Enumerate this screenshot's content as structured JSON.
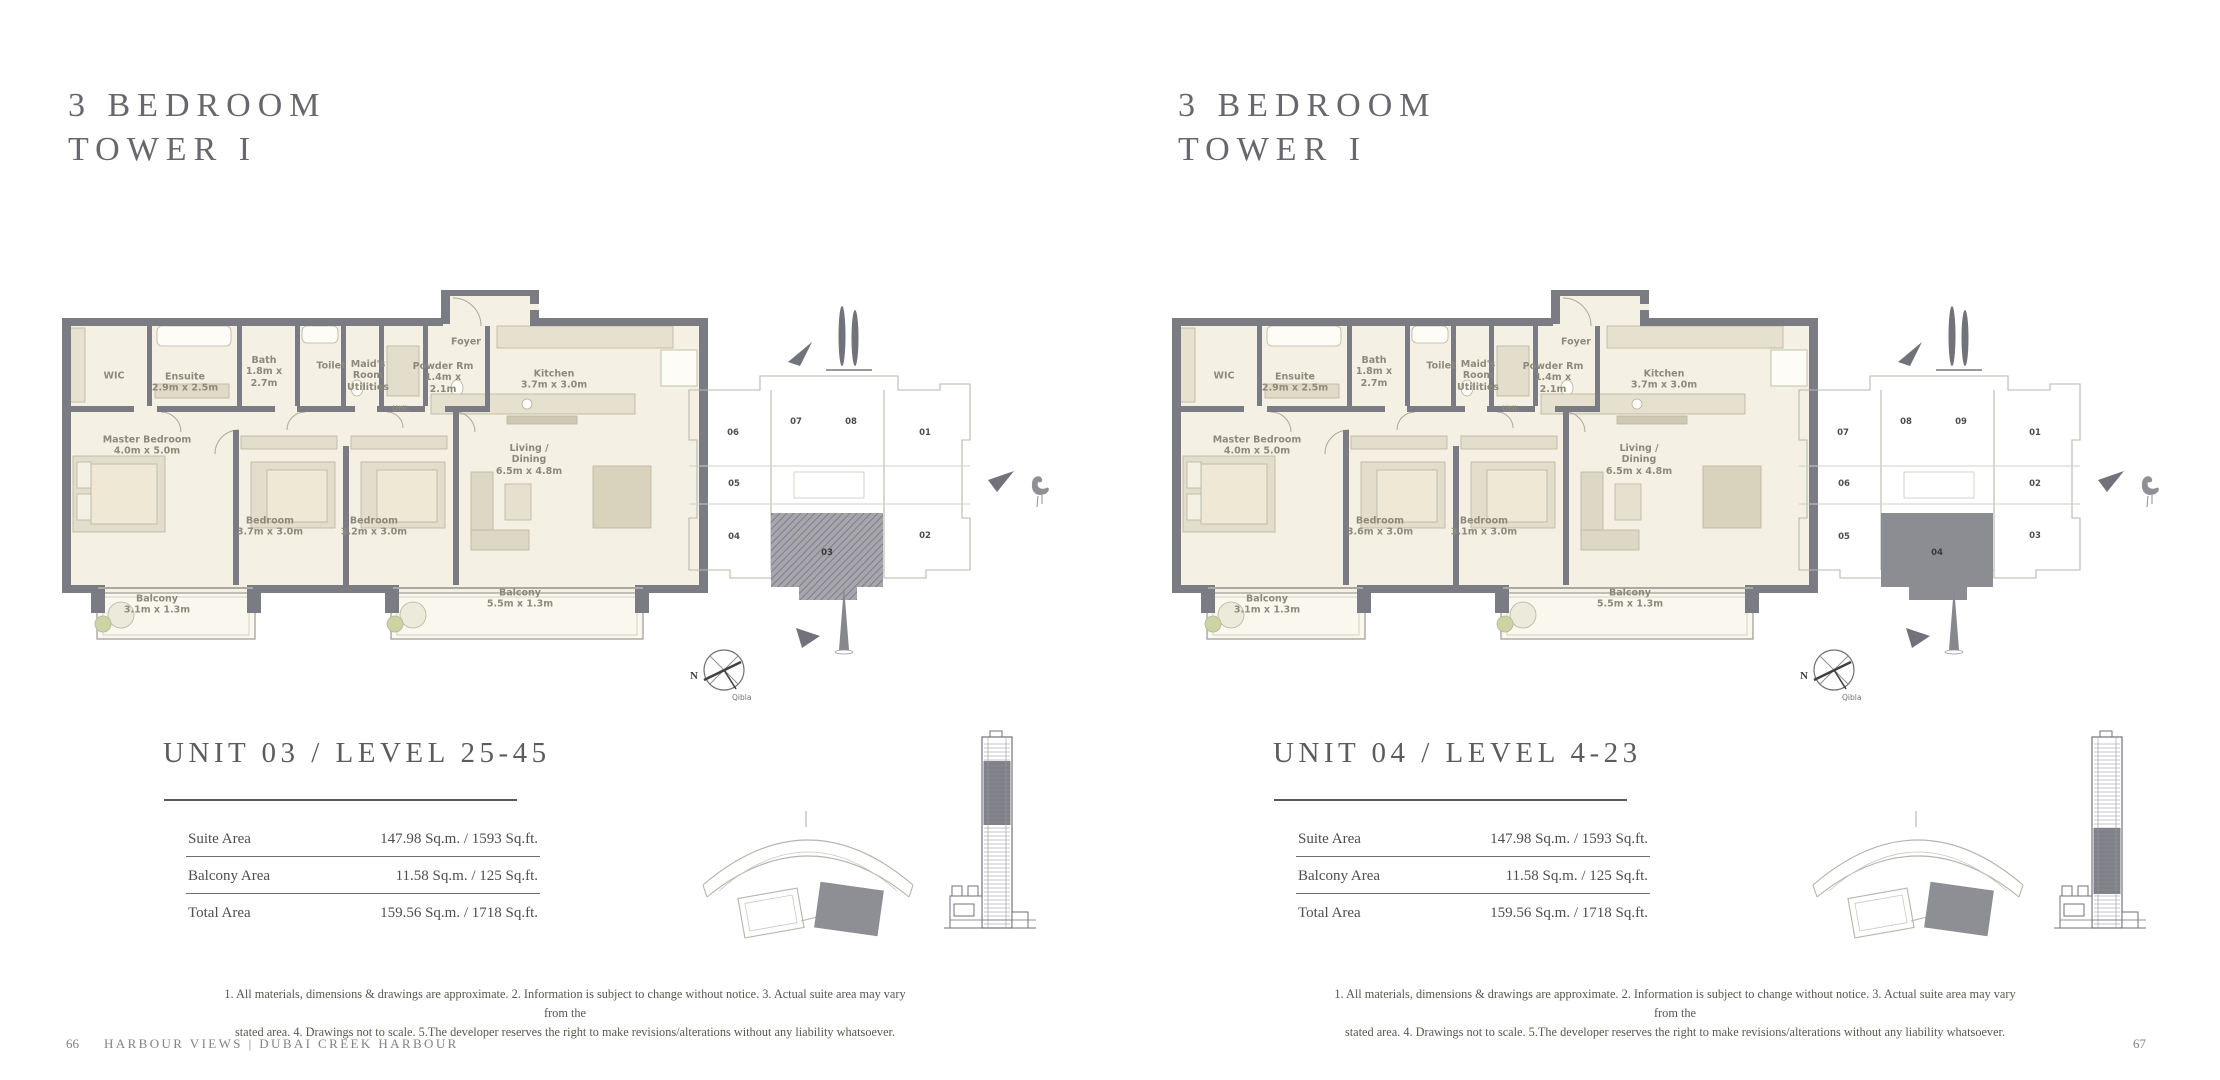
{
  "pages": [
    {
      "title_line1": "3 BEDROOM",
      "title_line2": "TOWER I",
      "plan": {
        "rooms": [
          {
            "lines": [
              "WIC"
            ],
            "x": 57,
            "y": 88
          },
          {
            "lines": [
              "Ensuite",
              "2.9m x 2.5m"
            ],
            "x": 128,
            "y": 95
          },
          {
            "lines": [
              "Bath",
              "1.8m x",
              "2.7m"
            ],
            "x": 207,
            "y": 84
          },
          {
            "lines": [
              "Toilet"
            ],
            "x": 274,
            "y": 78
          },
          {
            "lines": [
              "Maid's",
              "Room",
              "Utilities"
            ],
            "x": 311,
            "y": 88
          },
          {
            "lines": [
              "Powder Rm",
              "1.4m x",
              "2.1m"
            ],
            "x": 386,
            "y": 90
          },
          {
            "lines": [
              "Util."
            ],
            "x": 344,
            "y": 121,
            "small": true
          },
          {
            "lines": [
              "Foyer"
            ],
            "x": 409,
            "y": 54
          },
          {
            "lines": [
              "Kitchen",
              "3.7m x 3.0m"
            ],
            "x": 497,
            "y": 92
          },
          {
            "lines": [
              "Master Bedroom",
              "4.0m x 5.0m"
            ],
            "x": 90,
            "y": 158
          },
          {
            "lines": [
              "Bedroom",
              "3.7m x 3.0m"
            ],
            "x": 213,
            "y": 239
          },
          {
            "lines": [
              "Bedroom",
              "3.2m x 3.0m"
            ],
            "x": 317,
            "y": 239
          },
          {
            "lines": [
              "Living /",
              "Dining",
              "6.5m x 4.8m"
            ],
            "x": 472,
            "y": 172
          },
          {
            "lines": [
              "Balcony",
              "3.1m x 1.3m"
            ],
            "x": 100,
            "y": 317
          },
          {
            "lines": [
              "Balcony",
              "5.5m x 1.3m"
            ],
            "x": 463,
            "y": 311
          }
        ]
      },
      "keyplan": {
        "units": [
          {
            "n": "06",
            "x": 57,
            "y": 155
          },
          {
            "n": "07",
            "x": 120,
            "y": 144
          },
          {
            "n": "08",
            "x": 175,
            "y": 144
          },
          {
            "n": "01",
            "x": 249,
            "y": 155
          },
          {
            "n": "05",
            "x": 58,
            "y": 206
          },
          {
            "n": "04",
            "x": 58,
            "y": 259
          },
          {
            "n": "02",
            "x": 249,
            "y": 258
          }
        ],
        "highlight": {
          "n": "03",
          "x": 151,
          "y": 275,
          "style": "hatch"
        },
        "compass_n": "N",
        "compass_qibla": "Qibla"
      },
      "unit_heading": "UNIT 03 / LEVEL 25-45",
      "table": {
        "rows": [
          {
            "label": "Suite Area",
            "value": "147.98 Sq.m. / 1593 Sq.ft."
          },
          {
            "label": "Balcony Area",
            "value": "11.58 Sq.m. / 125 Sq.ft."
          },
          {
            "label": "Total Area",
            "value": "159.56 Sq.m. / 1718 Sq.ft."
          }
        ]
      },
      "tower_band": {
        "y": 33,
        "h": 64
      },
      "disclaimer_line1": "1. All materials, dimensions & drawings are approximate. 2. Information is subject to change without notice. 3. Actual suite area may vary from the",
      "disclaimer_line2": "stated area. 4. Drawings not to scale. 5.The developer reserves the right to make revisions/alterations without any liability whatsoever.",
      "footer": {
        "page_number": "66",
        "brochure_title": "HARBOUR VIEWS | DUBAI CREEK HARBOUR"
      }
    },
    {
      "title_line1": "3 BEDROOM",
      "title_line2": "TOWER I",
      "plan": {
        "rooms": [
          {
            "lines": [
              "WIC"
            ],
            "x": 57,
            "y": 88
          },
          {
            "lines": [
              "Ensuite",
              "2.9m x 2.5m"
            ],
            "x": 128,
            "y": 95
          },
          {
            "lines": [
              "Bath",
              "1.8m x",
              "2.7m"
            ],
            "x": 207,
            "y": 84
          },
          {
            "lines": [
              "Toilet"
            ],
            "x": 274,
            "y": 78
          },
          {
            "lines": [
              "Maid's",
              "Room",
              "Utilities"
            ],
            "x": 311,
            "y": 88
          },
          {
            "lines": [
              "Powder Rm",
              "1.4m x",
              "2.1m"
            ],
            "x": 386,
            "y": 90
          },
          {
            "lines": [
              "Util."
            ],
            "x": 344,
            "y": 121,
            "small": true
          },
          {
            "lines": [
              "Foyer"
            ],
            "x": 409,
            "y": 54
          },
          {
            "lines": [
              "Kitchen",
              "3.7m x 3.0m"
            ],
            "x": 497,
            "y": 92
          },
          {
            "lines": [
              "Master Bedroom",
              "4.0m x 5.0m"
            ],
            "x": 90,
            "y": 158
          },
          {
            "lines": [
              "Bedroom",
              "3.6m x 3.0m"
            ],
            "x": 213,
            "y": 239
          },
          {
            "lines": [
              "Bedroom",
              "3.1m x 3.0m"
            ],
            "x": 317,
            "y": 239
          },
          {
            "lines": [
              "Living /",
              "Dining",
              "6.5m x 4.8m"
            ],
            "x": 472,
            "y": 172
          },
          {
            "lines": [
              "Balcony",
              "3.1m x 1.3m"
            ],
            "x": 100,
            "y": 317
          },
          {
            "lines": [
              "Balcony",
              "5.5m x 1.3m"
            ],
            "x": 463,
            "y": 311
          }
        ]
      },
      "keyplan": {
        "units": [
          {
            "n": "07",
            "x": 57,
            "y": 155
          },
          {
            "n": "08",
            "x": 120,
            "y": 144
          },
          {
            "n": "09",
            "x": 175,
            "y": 144
          },
          {
            "n": "01",
            "x": 249,
            "y": 155
          },
          {
            "n": "06",
            "x": 58,
            "y": 206
          },
          {
            "n": "02",
            "x": 249,
            "y": 206
          },
          {
            "n": "05",
            "x": 58,
            "y": 259
          },
          {
            "n": "03",
            "x": 249,
            "y": 258
          }
        ],
        "highlight": {
          "n": "04",
          "x": 151,
          "y": 275,
          "style": "solid"
        },
        "compass_n": "N",
        "compass_qibla": "Qibla"
      },
      "unit_heading": "UNIT 04 / LEVEL 4-23",
      "table": {
        "rows": [
          {
            "label": "Suite Area",
            "value": "147.98 Sq.m. / 1593 Sq.ft."
          },
          {
            "label": "Balcony Area",
            "value": "11.58 Sq.m. / 125 Sq.ft."
          },
          {
            "label": "Total Area",
            "value": "159.56 Sq.m. / 1718 Sq.ft."
          }
        ]
      },
      "tower_band": {
        "y": 100,
        "h": 66
      },
      "disclaimer_line1": "1. All materials, dimensions & drawings are approximate. 2. Information is subject to change without notice. 3. Actual suite area may vary from the",
      "disclaimer_line2": "stated area. 4. Drawings not to scale. 5.The developer reserves the right to make revisions/alterations without any liability whatsoever.",
      "footer": {
        "page_number": "67",
        "brochure_title": ""
      }
    }
  ]
}
